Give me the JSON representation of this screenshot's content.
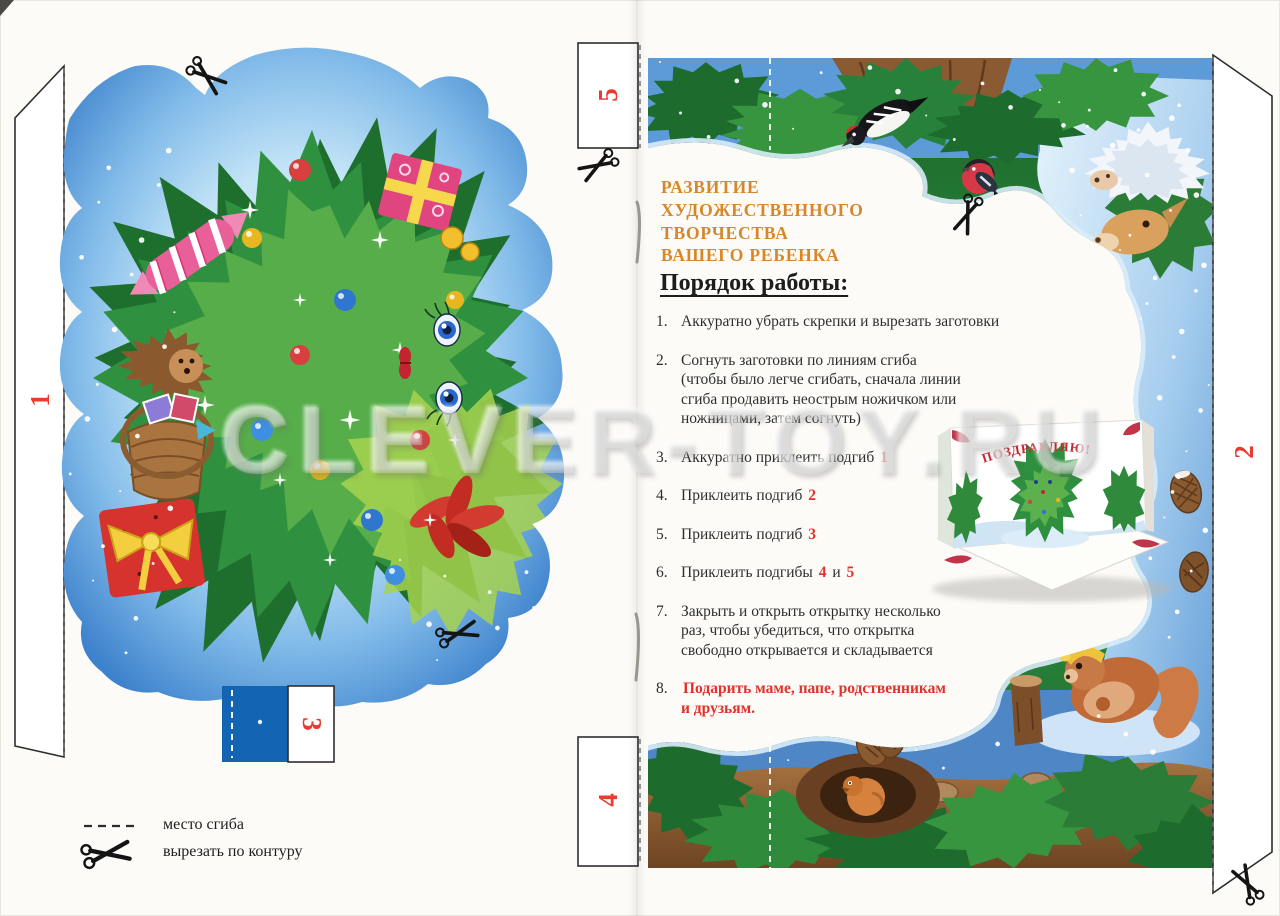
{
  "watermark": "CLEVER-TOY.RU",
  "heading": {
    "text": "РАЗВИТИЕ\nХУДОЖЕСТВЕННОГО\nТВОРЧЕСТВА\nВАШЕГО РЕБЕНКА",
    "color": "#d7872a"
  },
  "instructions": {
    "title": "Порядок работы:",
    "accent_red": "#e03228",
    "items": [
      {
        "num": "1.",
        "parts": [
          {
            "t": "Аккуратно убрать скрепки и вырезать заготовки"
          }
        ]
      },
      {
        "num": "2.",
        "parts": [
          {
            "t": "Согнуть заготовки по линиям сгиба\n(чтобы было легче сгибать, сначала линии\nсгиба продавить неострым ножичком или\nножницами, затем согнуть)"
          }
        ]
      },
      {
        "num": "3.",
        "parts": [
          {
            "t": "Аккуратно приклеить подгиб "
          },
          {
            "t": "1",
            "red": true
          }
        ]
      },
      {
        "num": "4.",
        "parts": [
          {
            "t": "Приклеить подгиб "
          },
          {
            "t": "2",
            "red": true
          }
        ]
      },
      {
        "num": "5.",
        "parts": [
          {
            "t": "Приклеить подгиб "
          },
          {
            "t": "3",
            "red": true
          }
        ]
      },
      {
        "num": "6.",
        "parts": [
          {
            "t": "Приклеить подгибы "
          },
          {
            "t": "4",
            "red": true
          },
          {
            "t": " и "
          },
          {
            "t": "5",
            "red": true
          }
        ]
      },
      {
        "num": "7.",
        "parts": [
          {
            "t": "Закрыть и открыть открытку несколько\nраз, чтобы убедиться, что открытка\nсвободно открывается и складывается"
          }
        ]
      },
      {
        "num": "8.",
        "parts": [
          {
            "t": "Подарить маме, папе, родственникам\nи друзьям.",
            "red": true
          }
        ]
      }
    ]
  },
  "tabs": [
    {
      "label": "1"
    },
    {
      "label": "2"
    },
    {
      "label": "3"
    },
    {
      "label": "4"
    },
    {
      "label": "5"
    }
  ],
  "legend": {
    "fold_label": "место сгиба",
    "cut_label": "вырезать по контуру"
  },
  "card": {
    "greeting": "ПОЗДРАВЛЯЮ!"
  },
  "colors": {
    "accent_orange": "#d7872a",
    "accent_red": "#e03228",
    "tab_number_red": "#ea3b2f"
  }
}
